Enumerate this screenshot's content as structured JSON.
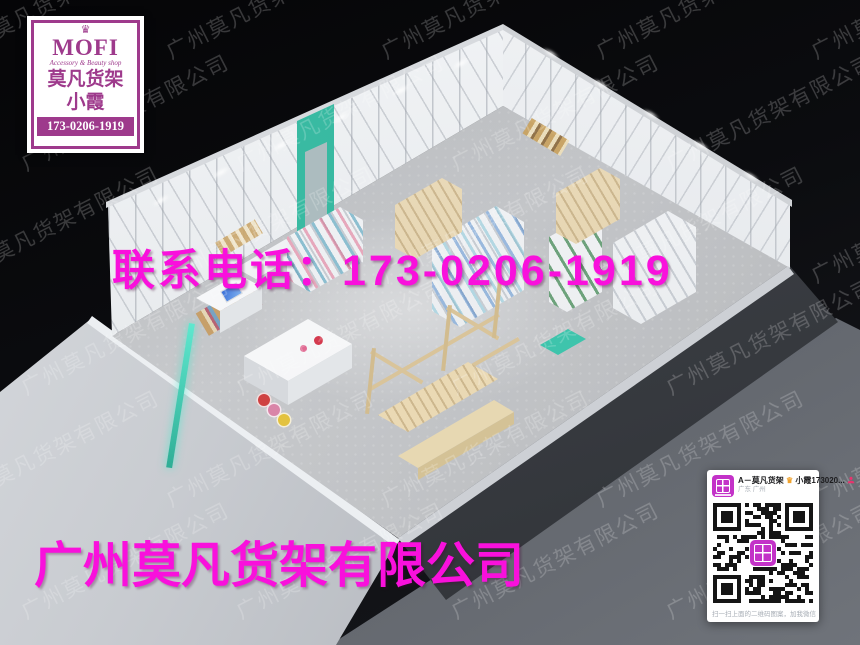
{
  "logo_card": {
    "crown_icon": "♛",
    "brand": "MOFI",
    "tagline": "Accessory & Beauty shop",
    "company_cn": "莫凡货架",
    "contact_name": "小霞",
    "phone": "173-0206-1919"
  },
  "overlays": {
    "contact_line": "联系电话：173-0206-1919",
    "company_line": "广州莫凡货架有限公司"
  },
  "watermark": {
    "text": "广州莫凡货架有限公司"
  },
  "qr_card": {
    "contact_title": "A－莫凡货架",
    "crown_icon": "♛",
    "contact_suffix": "小霞173020...",
    "location": "广东 广州",
    "caption": "扫一扫上面的二维码图案，加我微信"
  },
  "colors": {
    "magenta": "#F910DC",
    "logo_purple": "#9E3A8C",
    "teal_accent": "#3EC4AC",
    "qr_logo_purple": "#C332C8"
  }
}
